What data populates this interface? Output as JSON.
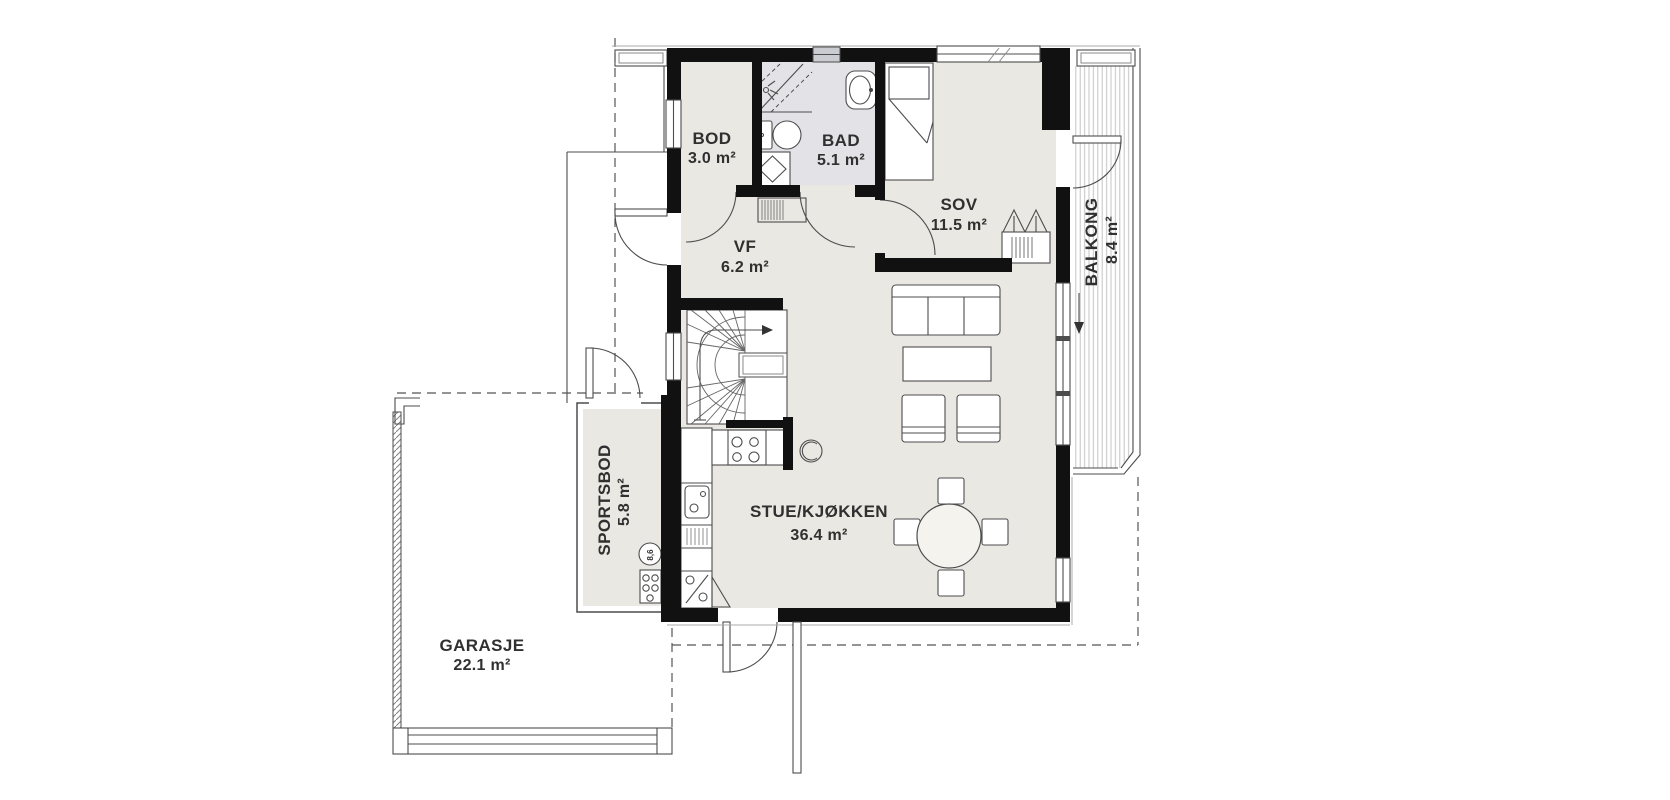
{
  "rooms": [
    {
      "id": "bod",
      "name": "BOD",
      "area": "3.0 m²"
    },
    {
      "id": "bad",
      "name": "BAD",
      "area": "5.1 m²"
    },
    {
      "id": "sov",
      "name": "SOV",
      "area": "11.5 m²"
    },
    {
      "id": "vf",
      "name": "VF",
      "area": "6.2 m²"
    },
    {
      "id": "stue",
      "name": "STUE/KJØKKEN",
      "area": "36.4 m²"
    },
    {
      "id": "balkong",
      "name": "BALKONG",
      "area": "8.4 m²",
      "label_rotated": true
    },
    {
      "id": "sportsbod",
      "name": "SPORTSBOD",
      "area": "5.8 m²",
      "label_rotated": true
    },
    {
      "id": "garasje",
      "name": "GARASJE",
      "area": "22.1 m²"
    }
  ],
  "fixtures": {
    "water_heater_label": "8,6"
  },
  "colors": {
    "wall": "#111111",
    "floor": "#e9e8e2",
    "bath_floor": "#e3e3e7",
    "line": "#4d4d4d",
    "text": "#303030",
    "deck_stripe": "#c3c3c3"
  }
}
